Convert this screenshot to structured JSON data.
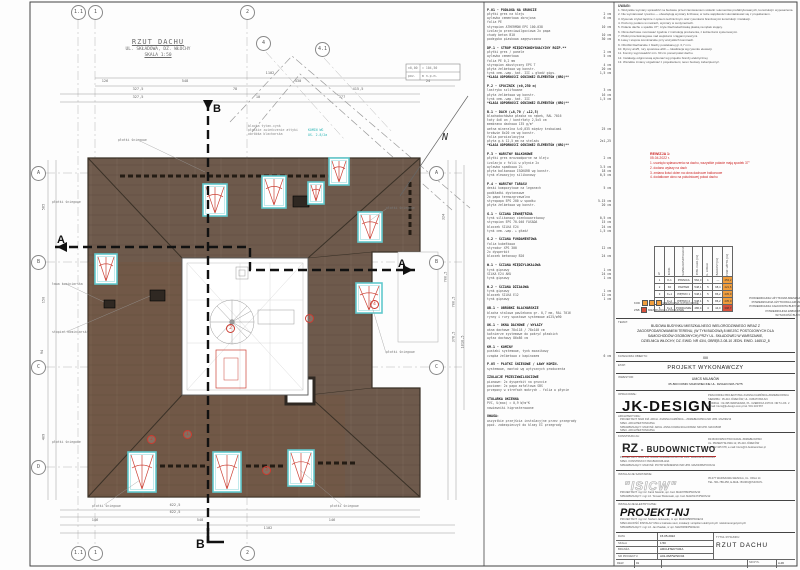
{
  "drawing": {
    "title": "RZUT DACHU",
    "subtitle": "UL. SKŁADOWA, DZ. WŁOCHY",
    "scale": "SKALA 1:50",
    "north": "N",
    "section_a": "A",
    "section_b": "B",
    "grid_top": [
      "1.1",
      "1",
      "2",
      "4",
      "4.1"
    ],
    "grid_bottom": [
      "1.1",
      "1",
      "2"
    ],
    "grid_right": [
      "A",
      "B",
      "C"
    ],
    "grid_left": [
      "A",
      "B",
      "C",
      "D"
    ],
    "datum": [
      "±0,00",
      "= 104,50",
      "poz.",
      "m n.p.m."
    ],
    "dims": {
      "t1": [
        "1102"
      ],
      "t2": [
        "126",
        "548",
        "430",
        "24"
      ],
      "t3": [
        "327,5",
        "78",
        "415,5"
      ],
      "t4": [
        "327,5",
        "10",
        "377"
      ],
      "b1": [
        "622,5"
      ],
      "b2": [
        "622,5"
      ],
      "b3": [
        "146",
        "548",
        "146"
      ],
      "b4": [
        "1102"
      ],
      "l": [
        "585",
        "150",
        "94",
        "409"
      ],
      "r1": [
        "324",
        "700,5"
      ],
      "r2": [
        "700,5",
        "378,5"
      ],
      "r3": [
        "1010,5"
      ]
    },
    "callouts": [
      "płotki śniegowe",
      "płotki śniegowe",
      "płotki śniegowe",
      "płotki śniegowe",
      "ława kominiarska",
      "stopień kominiarski",
      "płotki śniegowe",
      "płotki śniegowe",
      "płotki śniegowe"
    ],
    "callouts_cyan": [
      "KOMIN WG",
      "OS. 2.8/2a"
    ],
    "note_lines": [
      "blacha tytan-cynk",
      "płaskie zwieńczenie attyki",
      "obróbka blacharska"
    ],
    "red_marks": [
      "1",
      "2",
      "1",
      "2",
      "3",
      "4"
    ]
  },
  "specs": {
    "sections": [
      {
        "h": "P.01 - PODŁOGA NA GRUNCIE",
        "lines": [
          [
            "płytki gres na kleju",
            "2 cm"
          ],
          [
            "wylewka cementowa zbrojona",
            "6 cm"
          ],
          [
            "folia PE",
            ""
          ],
          [
            "styropian ATHERMON EPS 100-038",
            "10 cm"
          ],
          [
            "izolacja przeciwwilgociowa 2x papa",
            ""
          ],
          [
            "chudy beton B10",
            "10 cm"
          ],
          [
            "podsypka piaskowa zagęszczona",
            "30 cm"
          ]
        ]
      },
      {
        "h": "DP.1 - STROP MIĘDZYKONDYGNACYJNY ROZP.**",
        "lines": [
          [
            "płytki gres / panele",
            "2 cm"
          ],
          [
            "wylewka cementowa",
            "5 cm"
          ],
          [
            "folia PE 0,2 mm",
            ""
          ],
          [
            "styropian akustyczny EPS T",
            "4 cm"
          ],
          [
            "płyta żelbetowa wg konstr.",
            "20 cm"
          ],
          [
            "tynk cem.-wap. kat. III + gładź gips.",
            "1,5 cm"
          ],
          [
            "*KLASA ODPORNOŚCI OGNIOWEJ ELEMENTÓW (NRO)**",
            ""
          ]
        ]
      },
      {
        "h": "P.2 - SPOCZNIK (±0,250 m)",
        "lines": [
          [
            "lastryko szlifowane",
            "3 cm"
          ],
          [
            "płyta żelbetowa wg konstr.",
            "16 cm"
          ],
          [
            "tynk cem.-wap. kat. III",
            "1,5 cm"
          ],
          [
            "*KLASA ODPORNOŚCI OGNIOWEJ ELEMENTÓW (NRO)**",
            ""
          ]
        ]
      },
      {
        "h": "B.1 - DACH (+8,70 / +12,5)",
        "lines": [
          [
            "blachodachówka płaska na rąbek, RAL 7016",
            ""
          ],
          [
            "łaty 4x6 cm / kontrłaty 2,5x5 cm",
            ""
          ],
          [
            "membrana dachowa 135 g/m²",
            ""
          ],
          [
            "wełna mineralna λ=0,035 między krokwiami",
            "25 cm"
          ],
          [
            "krokwie 8x20 cm wg konstr.",
            ""
          ],
          [
            "folia paroizolacyjna",
            ""
          ],
          [
            "płyta g-k 12,5 mm na stelażu",
            "2x1,25"
          ],
          [
            "*KLASA ODPORNOŚCI OGNIOWEJ ELEMENTÓW (NRO)**",
            ""
          ]
        ]
      },
      {
        "h": "P.3 - WARSTWY BALKONOWE",
        "lines": [
          [
            "płytki gres mrozoodporne na kleju",
            "2 cm"
          ],
          [
            "izolacja z folii w płynie 2x",
            ""
          ],
          [
            "wylewka spadkowa 2%",
            "3-5 cm"
          ],
          [
            "płyta balkonowa ISOKORB wg konstr.",
            "18 cm"
          ],
          [
            "tynk elewacyjny silikonowy",
            "0,5 cm"
          ]
        ]
      },
      {
        "h": "P.4 - WARSTWY TARASU",
        "lines": [
          [
            "deski kompozytowe na legarach",
            "5 cm"
          ],
          [
            "podkładki dystansowe",
            ""
          ],
          [
            "2x papa termozgrzewalna",
            ""
          ],
          [
            "styropapa EPS 200 w spadku",
            "5-15 cm"
          ],
          [
            "płyta żelbetowa wg konstr.",
            "20 cm"
          ]
        ]
      },
      {
        "h": "G.1 - ŚCIANA ZEWNĘTRZNA",
        "lines": [
          [
            "tynk silikonowy cienkowarstwowy",
            "0,5 cm"
          ],
          [
            "styropian EPS 70-040 FASADA",
            "15 cm"
          ],
          [
            "bloczek SILKA E24",
            "24 cm"
          ],
          [
            "tynk cem.-wap. + gładź",
            "1,5 cm"
          ]
        ]
      },
      {
        "h": "G.2 - ŚCIANA FUNDAMENTOWA",
        "lines": [
          [
            "folia kubełkowa",
            ""
          ],
          [
            "styrodur XPS 300",
            "12 cm"
          ],
          [
            "2x dysperbit",
            ""
          ],
          [
            "bloczek betonowy B20",
            "24 cm"
          ]
        ]
      },
      {
        "h": "W.1 - ŚCIANA MIĘDZYLOKALOWA",
        "lines": [
          [
            "tynk gipsowy",
            "1 cm"
          ],
          [
            "SILKA E24 AKU",
            "24 cm"
          ],
          [
            "tynk gipsowy",
            "1 cm"
          ]
        ]
      },
      {
        "h": "W.2 - ŚCIANA DZIAŁOWA",
        "lines": [
          [
            "tynk gipsowy",
            "1 cm"
          ],
          [
            "bloczek SILKA E12",
            "12 cm"
          ],
          [
            "tynk gipsowy",
            "1 cm"
          ]
        ]
      },
      {
        "h": "OB.1 - OBRÓBKI BLACHARSKIE",
        "lines": [
          [
            "blacha stalowa powlekana gr. 0,7 mm, RAL 7016",
            ""
          ],
          [
            "rynny i rury spustowe systemowe ø125/ø90",
            ""
          ]
        ]
      },
      {
        "h": "OK.1 - OKNA DACHOWE / WYŁAZY",
        "lines": [
          [
            "okna dachowe 78x118 / 78x140 cm",
            ""
          ],
          [
            "kołnierze systemowe do pokryć płaskich",
            ""
          ],
          [
            "wyłaz dachowy 86x86 cm",
            ""
          ]
        ]
      },
      {
        "h": "KM.1 - KOMINY",
        "lines": [
          [
            "pustaki systemowe, tynk mozaikowy",
            ""
          ],
          [
            "czapka żelbetowa z kapinosem",
            "6 cm"
          ]
        ]
      },
      {
        "h": "P.05 - PŁOTKI ŚNIEGOWE / ŁAWY KOMIN.",
        "lines": [
          [
            "systemowe, montaż wg wytycznych producenta",
            ""
          ]
        ]
      },
      {
        "h": "IZOLACJE PRZECIWWILGOCIOWE",
        "lines": [
          [
            "pionowe: 2x dysperbit na gruncie",
            ""
          ],
          [
            "poziome: 2x papa asfaltowa SBS",
            ""
          ],
          [
            "przepony w strefach mokrych - folia w płynie",
            ""
          ]
        ]
      },
      {
        "h": "STOLARKA OKIENNA",
        "lines": [
          [
            "PVC, U(max) = 0,9 W/m²K",
            ""
          ],
          [
            "nawiewniki higrosterowane",
            ""
          ]
        ]
      },
      {
        "h": "UWAGA:",
        "lines": [
          [
            "wszystkie przejścia instalacyjne przez przegrody",
            ""
          ],
          [
            "ppoż. zabezpieczyć do klasy EI przegrody",
            ""
          ]
        ]
      }
    ]
  },
  "notes": {
    "title": "UWAGI:",
    "items": [
      "1. Wszystkie wymiary sprawdzić na budowie przed zamówieniem stolarki i elementów prefabrykowanych, konstrukcji i wyposażenia.",
      "2. Nie wymiarować rysunku — obowiązują wymiary liczbowe; w razie wątpliwości skontaktować się z projektantem.",
      "3. Rysunek czytać łącznie z opisem technicznym oraz rysunkami branżowymi konstrukcji i instalacji.",
      "4. Poziomy podano w metrach, wymiary w centymetrach.",
      "5. Połacie dachu o spadku 37°, kryte blachodachówką płaską na rąbek stojący.",
      "6. Okna dachowe montować zgodnie z instrukcją producenta, z kołnierzami systemowymi.",
      "7. Płotki przeciwśniegowe nad wejściami i ciągami pieszymi.",
      "8. Ławy i stopnie kominiarskie przy wszystkich kominach.",
      "9. Obróbki blacharskie z blachy powlekanej gr. 0,7 mm.",
      "10. Rynny ø125, rury spustowe ø90 — lokalizacja wg rysunku elewacji.",
      "11. Kominy wyprowadzić min. 60 cm ponad połać dachu.",
      "12. Instalację odgromową wykonać wg projektu branży elektrycznej.",
      "13. Wszelkie zmiany uzgadniać z projektantem; teren budowy zabezpieczyć."
    ]
  },
  "revision": {
    "title": "REWIZJA 1:",
    "date": "05.04.2022 r.",
    "items": [
      "1. usunięto spłaszczenia na dachu, wszystkie połacie mają spadek 37°",
      "2. dodano wyłazy na dach",
      "3. zmiana ilości okien na okna dachowe balkonowe",
      "4. dodatkowe okno na południowej połaci dachu"
    ]
  },
  "areas_table": {
    "headers": [
      "LP",
      "KOND.",
      "NAZWA KONDYGNACJI",
      "POW. CAŁK. [m²]",
      "IL. LOKALI",
      "BALKONY [m²]",
      "POW. UŻYTK. [m²]"
    ],
    "rows": [
      [
        "1",
        "K-1",
        "PIWNICA",
        "562,3",
        "1",
        "—",
        "453,2"
      ],
      [
        "2",
        "K0",
        "PARTER",
        "548,1",
        "5",
        "98,4",
        "421,6"
      ],
      [
        "3",
        "K+1",
        "PIĘTRO 1",
        "548,1",
        "5",
        "86,2",
        "435,0"
      ],
      [
        "4",
        "K+2",
        "PIĘTRO 2",
        "548,1",
        "5",
        "86,2",
        "435,0"
      ],
      [
        "5",
        "K+3",
        "PODDASZE",
        "486,4",
        "4",
        "44,0",
        "398,7"
      ]
    ],
    "legend": [
      {
        "pre": "KOD",
        "squares": [
          "#f09d3c",
          "#f09d3c",
          "#f09d3c"
        ],
        "label": "MIESZKANIA 3-POKOJOWE"
      },
      {
        "pre": "ZSB",
        "squares": [
          "#d6503c"
        ],
        "label": "MIESZKANIA 2-POKOJOWE"
      }
    ],
    "summary": [
      [
        "POWIERZCHNIA UŻYTKOWA MIESZKAŃ:",
        "2657,54 m²"
      ],
      [
        "POWIERZCHNIA UŻYTKOWA ŁAZIENEK:",
        "259,82 m²"
      ],
      [
        "POWIERZCHNIA CAŁKOWITA BUDYNKU:",
        "2929,04 m²"
      ],
      [
        "POWIERZCHNIA ZABUDOWY:",
        "549,86 m²"
      ],
      [
        "WYSOKOŚĆ BUDYNKU:",
        "12,04 m"
      ]
    ]
  },
  "title_block": {
    "temat_label": "TEMAT:",
    "temat_lines": [
      "BUDOWA BUDYNKU MIESZKALNEGO WIELORODZINNEGO WRAZ Z",
      "ZAGOSPODAROWANIEM TERENU, (W TYM BUDOWĄ 8 MIEJSC POSTOJOWYCH DLA",
      "SAMOCHODÓW OSOBOWYCH) PRZY UL. SKŁADOWEJ W WARSZAWIE,",
      "DZIELNICA WŁOCHY, DZ. EWID. NR 43/4, OBRĘB 2-08-10 JEDN. EWID. 146512_8"
    ],
    "kategoria_label": "KATEGORIA OBIEKTU:",
    "kategoria_value": "XIII",
    "etap_label": "ETAP:",
    "etap_value": "PROJEKT WYKONAWCZY",
    "inwestor_label": "INWESTOR:",
    "inwestor_lines": [
      "UMCS MILANÓW",
      "05-800 DOMKI MAZOWIECKIE  UL. DZIAŁKOWA 73/75"
    ],
    "oprac_label": "OPRACOWAŁ:",
    "oprac_logo": "JK-DESIGN",
    "oprac_lines": [
      "PRACOWNIA PROJEKTOWA JOANNA KAMIŃSKA-ZDZIEBŁOWSKA",
      "SIEDZIBA : 05-410 JÓZEFÓW, UL. KWIATOWA 6/4",
      "ODDZIAŁ : 02-495 WARSZAWA, PL. CZERWCA 1976 R. NR 5 LOK. 2",
      "e-mail: biuro@jk-design.com.pl   tel. 501 234 567"
    ],
    "arch_label": "ARCHITEKTURA:",
    "arch_lines": [
      "PROJEKTANT: MGR INŻ. ARCH. JOANNA KAMIŃSKA – ZDZIEBŁOWSKA    NR UPR. MA/099/13",
      "SPEC. ARCHITEKTONICZNA",
      "SPRAWDZAJĄCY: MGR INŻ. ARCH. ANNA KOWALSKA-NOWAK    NR UPR. MA/015/08",
      "SPEC. ARCHITEKTONICZNA"
    ],
    "konstr_label": "KONSTRUKCJA:",
    "konstr_logo_prefix": "RZ",
    "konstr_logo_suffix": " - BUDOWNICTWO",
    "konstr_addr_lines": [
      "RZ-BUDOWNICTWO RAFAŁ ZDZIEBŁOWSKI",
      "UL. PRZEMYSŁOWA 12, 05-410 JÓZEFÓW",
      "tel. 602 345 678, e-mail: biuro@rz-budownictwo.pl"
    ],
    "konstr_lines": [
      "PROJEKTANT: MGR INŻ. RAFAŁ ZDZIEBŁOWSKI    NR UPR. MAZ/0123/POOK/09",
      "SPEC. KONSTRUKCYJNO-BUDOWLANA",
      "SPRAWDZAJĄCY: MGR INŻ. PIOTR WIŚNIEWSKI    NR UPR. MAZ/0456/POOK/11"
    ],
    "sanit_label": "INSTALACJE SANITARNE:",
    "sanit_logo": "\"ISICW\"",
    "sanit_addr_lines": [
      "05-077 WARSZAWA-WESOŁA, UL. ORLA 14",
      "TEL. 501-789-456, E-MAIL: BIURO@ISICW.PL"
    ],
    "sanit_lines": [
      "PROJEKTANT:  mgr inż. Karol Nowicki, upr. bud. MAZ/0789/PWOS/10",
      "SPRAWDZAJĄCY:  mgr inż. Tomasz Borkowski, upr. bud. MAZ/0147/PWOS/12"
    ],
    "elektr_label": "INSTALACJE ELEKTRYCZNE:",
    "elektr_logo": "PROJEKT-NJ",
    "elektr_lines": [
      "PROJEKTANT: mgr inż. Norbert Jankowski, nr upr. MAZ/0258/PWOE/13",
      "SPECJALNOŚĆ INSTALACYJNA w zakresie sieci, instalacji i urządzeń elektrycznych i elektroenergetycznych",
      "SPRAWDZAJĄCY: mgr inż. Jan Pawlak, nr upr. MAZ/0369/PWOE/14"
    ]
  },
  "bottom_table": {
    "rows": [
      [
        "DATA",
        "15.05.2022"
      ],
      [
        "SKALA",
        "1:50"
      ],
      [
        "BRANŻA",
        "ARCHITEKTURA"
      ],
      [
        "NR PROJEKTU",
        "A01-06/PW/SK/04"
      ]
    ],
    "title_label": "TYTUŁ RYSUNKU:",
    "title": "RZUT DACHU",
    "rev_label": "REW.",
    "rev_value": "01",
    "sheet_label": "NR RYS.",
    "sheet_value": "A-06"
  }
}
